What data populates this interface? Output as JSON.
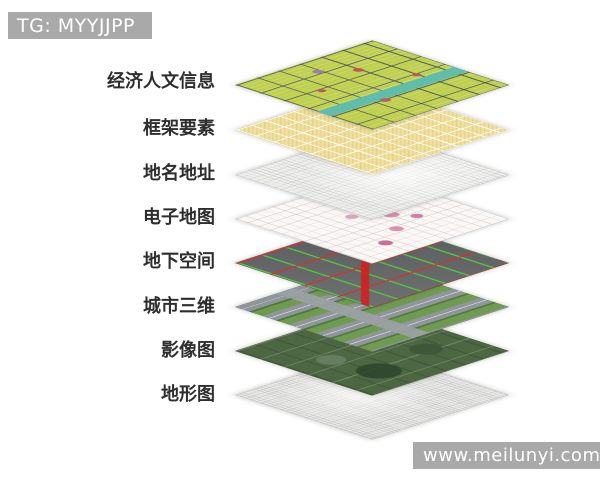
{
  "watermark_top": {
    "text": "TG: MYYJJPP"
  },
  "watermark_bottom": {
    "text": "www.meilunyi.com"
  },
  "colors": {
    "background": "#ffffff",
    "watermark_bg": "#a9a9a9",
    "watermark_text": "#ffffff",
    "label_text": "#2e2e2e"
  },
  "layers": [
    {
      "name": "economic-humanities-info",
      "label": "经济人文信息",
      "base_color": "#bfd04f"
    },
    {
      "name": "framework-elements",
      "label": "框架要素",
      "base_color": "#efe09c"
    },
    {
      "name": "place-names-addresses",
      "label": "地名地址",
      "base_color": "#efefed"
    },
    {
      "name": "electronic-map",
      "label": "电子地图",
      "base_color": "#faf7f4"
    },
    {
      "name": "underground-space",
      "label": "地下空间",
      "base_color": "#5c5e60"
    },
    {
      "name": "urban-3d",
      "label": "城市三维",
      "base_color": "#6f9b50"
    },
    {
      "name": "imagery-map",
      "label": "影像图",
      "base_color": "#4d6742"
    },
    {
      "name": "topographic-map",
      "label": "地形图",
      "base_color": "#e9e9e7"
    }
  ]
}
